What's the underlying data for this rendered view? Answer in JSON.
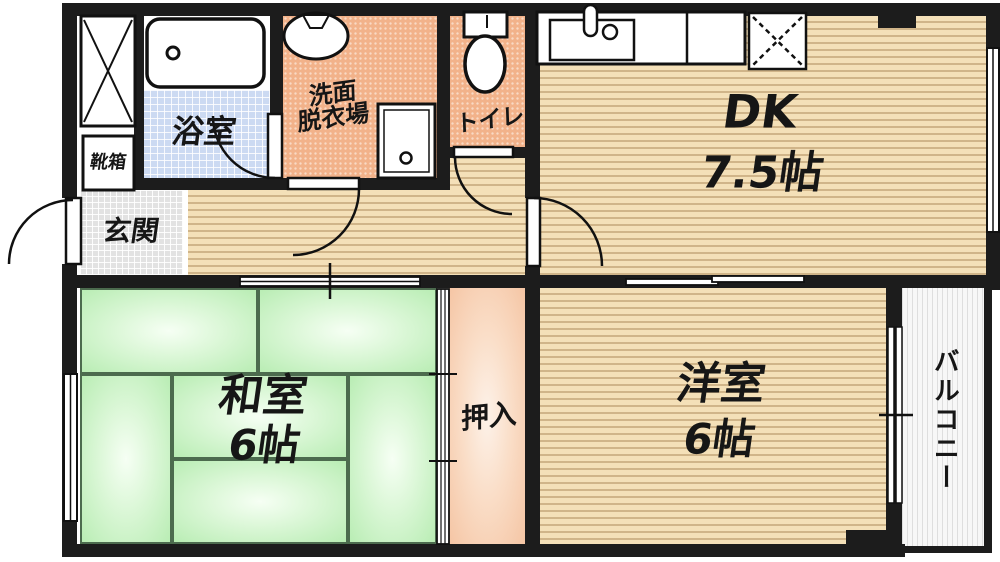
{
  "plan_title": "apartment floor plan",
  "rooms": {
    "dk": {
      "label": "DK",
      "size": "7.5帖"
    },
    "washitsu": {
      "label": "和室",
      "size": "6帖"
    },
    "youshitsu": {
      "label": "洋室",
      "size": "6帖"
    },
    "oshiire": {
      "label": "押入"
    },
    "balcony": {
      "label": "バルコニー"
    },
    "bathroom": {
      "label": "浴室"
    },
    "washroom": {
      "label_line1": "洗面",
      "label_line2": "脱衣場"
    },
    "toilet": {
      "label": "トイレ"
    },
    "genkan": {
      "label": "玄関"
    },
    "shoebox": {
      "label": "靴箱"
    }
  },
  "icons": {
    "bathtub-icon": "rounded rectangle tub with drain circle",
    "wash-basin-icon": "oval basin with faucet notch",
    "washing-machine-pan-icon": "square pan with drain circle",
    "toilet-icon": "tank and bowl",
    "kitchen-counter-icon": "counter with inset sink, faucet and knob",
    "refrigerator-space-icon": "square with dashed X",
    "pipe-space-icon": "square with solid X",
    "door-swing-icon": "quarter-circle swing arc",
    "sliding-door-icon": "offset double track bars",
    "window-icon": "double-line window bar"
  },
  "colors": {
    "wall": "#1c1c1c",
    "wood_floor": "#f4e0b8",
    "wood_stripe": "#966e3c",
    "tatami_green": "#b9edb4",
    "bath_floor_blue": "#ccdaf2",
    "sanitary_salmon": "#f2b28a",
    "genkan_gray": "#e2e2e2",
    "closet_pink": "#f5c5a4",
    "balcony_white": "#f7f7f7",
    "fixture_white": "#ffffff",
    "text": "#161616"
  }
}
